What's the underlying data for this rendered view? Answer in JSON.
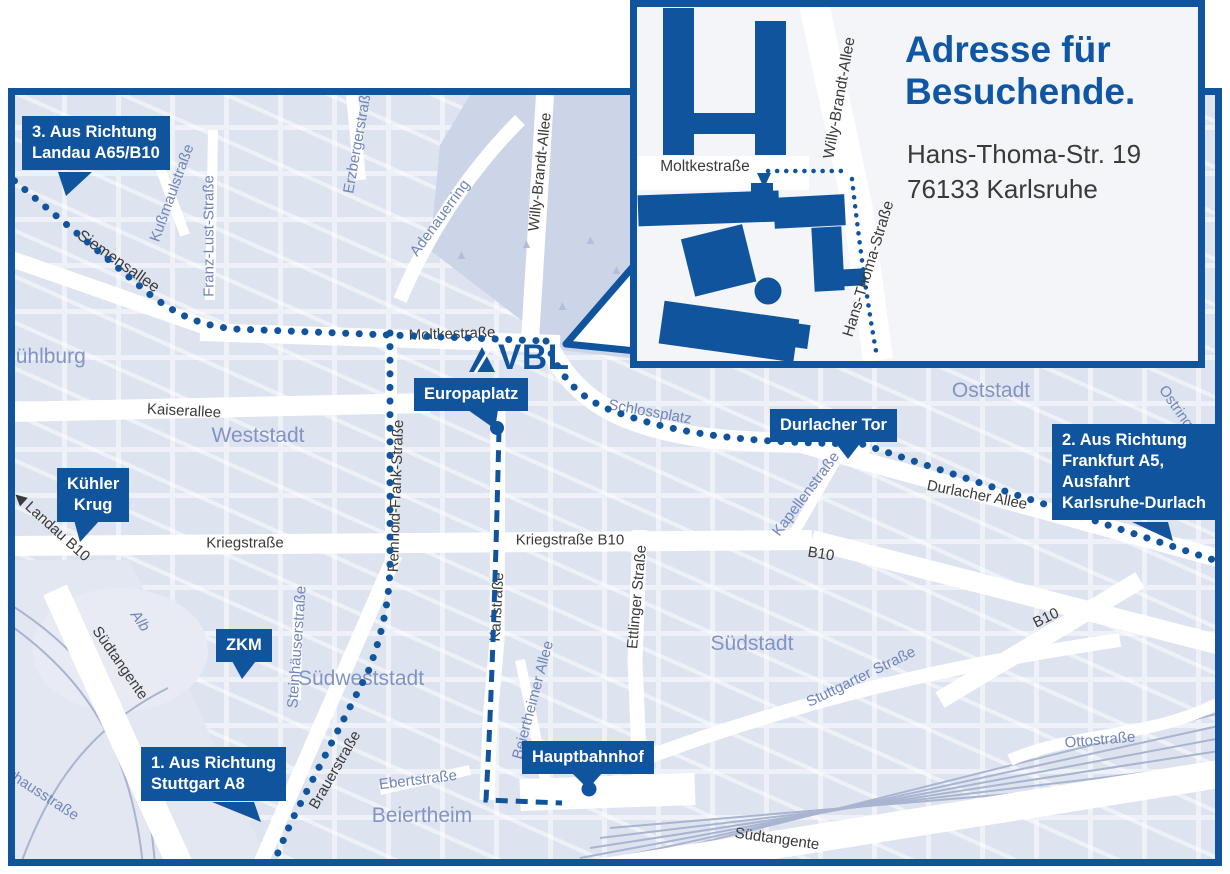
{
  "colors": {
    "brand_blue": "#11549e",
    "title_blue": "#0f57a5",
    "street_dark": "#3a3a39",
    "street_blue": "#7085ba",
    "district_blue": "#8394c4",
    "map_background": "#dde3ef",
    "park": "#ccd4e7",
    "route_dots": "#11549e"
  },
  "logo": {
    "text": "VBL"
  },
  "icons": {
    "direction_west_arrow": "◀",
    "route_arrow_down": "▼",
    "tree": "▲"
  },
  "inset": {
    "title_line1": "Adresse für",
    "title_line2": "Besuchende.",
    "address_line1": "Hans-Thoma-Str. 19",
    "address_line2": "76133 Karlsruhe",
    "streets": {
      "moltke": "Moltkestraße",
      "willy": "Willy-Brandt-Allee",
      "hans_thoma": "Hans-Thoma-Straße"
    }
  },
  "badges": [
    {
      "id": "route-3-landau",
      "lines": [
        "3. Aus Richtung",
        "Landau A65/B10"
      ]
    },
    {
      "id": "kuehler-krug",
      "lines": [
        "Kühler",
        "Krug"
      ]
    },
    {
      "id": "zkm",
      "lines": [
        "ZKM"
      ]
    },
    {
      "id": "route-1-stuttgart",
      "lines": [
        "1. Aus Richtung",
        "Stuttgart A8"
      ]
    },
    {
      "id": "europaplatz",
      "lines": [
        "Europaplatz"
      ]
    },
    {
      "id": "hauptbahnhof",
      "lines": [
        "Hauptbahnhof"
      ]
    },
    {
      "id": "durlacher-tor",
      "lines": [
        "Durlacher Tor"
      ]
    },
    {
      "id": "route-2-frankfurt",
      "lines": [
        "2. Aus Richtung",
        "Frankfurt A5,",
        "Ausfahrt",
        "Karlsruhe-Durlach"
      ]
    }
  ],
  "streets": [
    "Siemensallee",
    "Kußmaulstraße",
    "Franz-Lust-Straße",
    "Erzbergerstraße",
    "Adenauerring",
    "Willy-Brandt-Allee",
    "Moltkestraße",
    "Kaiserallee",
    "Schlossplatz",
    "Durlacher Allee",
    "Kapellenstraße",
    "Kriegstraße",
    "Kriegstraße B10",
    "B10",
    "B10",
    "Reinhold-Frank-Straße",
    "Karlstraße",
    "Ettlinger Straße",
    "Beiertheimer Allee",
    "Steinhäuserstraße",
    "Brauerstraße",
    "Ebertstraße",
    "Südtangente",
    "Südtangente",
    "Ottostraße",
    "Stuttgarter Straße",
    "Alb",
    "Landau B10",
    "Ostring",
    "Pulverhausstraße"
  ],
  "districts": [
    "Mühlburg",
    "Weststadt",
    "Oststadt",
    "Südstadt",
    "Südweststadt",
    "Beiertheim"
  ]
}
